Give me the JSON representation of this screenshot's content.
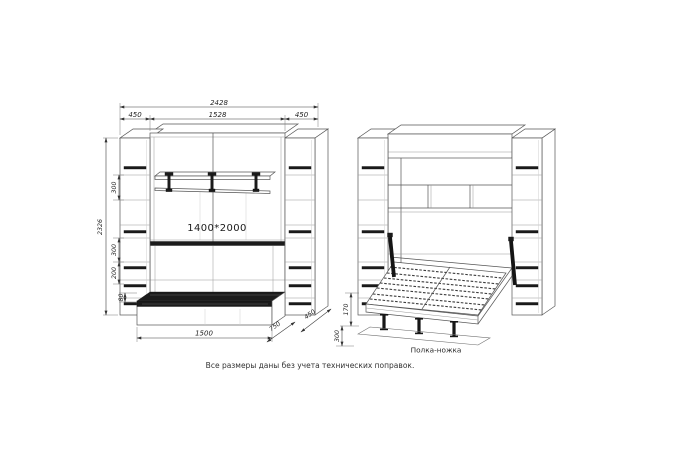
{
  "caption": "Все размеры даны без учета технических поправок.",
  "closed_view": {
    "width_total": "2428",
    "width_left": "450",
    "width_center": "1528",
    "width_right": "450",
    "height_total": "2326",
    "seg_shelf_top": "300",
    "seg_shelf_bottom": "300",
    "seg_drawers": "200",
    "seg_plinth": "80",
    "bed_size": "1400*2000",
    "bench_width": "1500",
    "bench_depth": "750",
    "side_depth": "450"
  },
  "open_view": {
    "bed_frame_height": "170",
    "underbed_clearance": "300",
    "shelf_leg_label": "Полка-ножка"
  }
}
